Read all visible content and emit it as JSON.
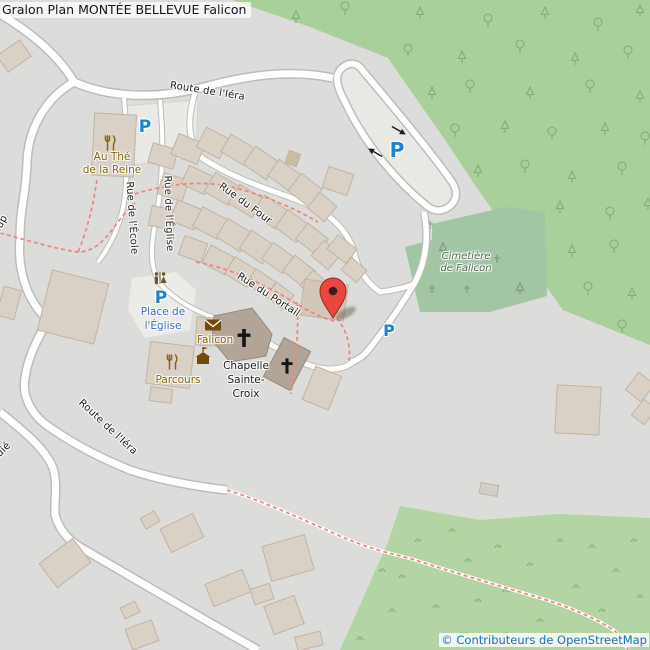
{
  "map": {
    "title": "Gralon Plan MONTÉE BELLEVUE Falicon",
    "attribution": "© Contributeurs de OpenStreetMap",
    "parking_label": "P",
    "streets": {
      "route_iera_top": "Route de l'Iéra",
      "route_iera_bottom": "Route de l'Iéra",
      "rue_ecole": "Rue de l'École",
      "rue_eglise": "Rue de l'Église",
      "rue_four": "Rue du Four",
      "rue_portail": "Rue du Portail",
      "fragment_top_left": "dup",
      "fragment_bottom_left": "uié"
    },
    "pois": {
      "restaurant1": {
        "line1": "Au Thé",
        "line2": "de la Reine"
      },
      "restaurant2": "Parcours",
      "post_office": "Falicon",
      "chapel": {
        "line1": "Chapelle",
        "line2": "Sainte-",
        "line3": "Croix"
      },
      "square": {
        "line1": "Place de",
        "line2": "l'Église"
      },
      "cemetery": {
        "line1": "Cimetière",
        "line2": "de Falicon"
      }
    },
    "icons": {
      "marker": "red-map-pin",
      "parking": "blue-P",
      "restaurant": "fork-and-knife",
      "post_office": "envelope",
      "town_hall": "civic-building-with-flag",
      "toilets": "man-woman-figures",
      "church": "black-cross",
      "forest_trees": "broadleaf-and-conifer-outlines",
      "grass": "tuft",
      "grave": "small-cross",
      "one_way": "black-arrow"
    },
    "colors": {
      "land": "#dcdcda",
      "forest": "#a9cf9b",
      "cemetery": "#a2c5a4",
      "scrub": "#b2d5a3",
      "road": "#ffffff",
      "building": "#d9d0c6",
      "religious_building": "#b2a597",
      "path_dashed": "#f0837b",
      "parking_blue": "#1d83cf",
      "poi_brown": "#8a6510",
      "label_blue": "#3a6fc3",
      "marker_red": "#e8463e",
      "attribution_blue": "#1a70c0"
    }
  }
}
